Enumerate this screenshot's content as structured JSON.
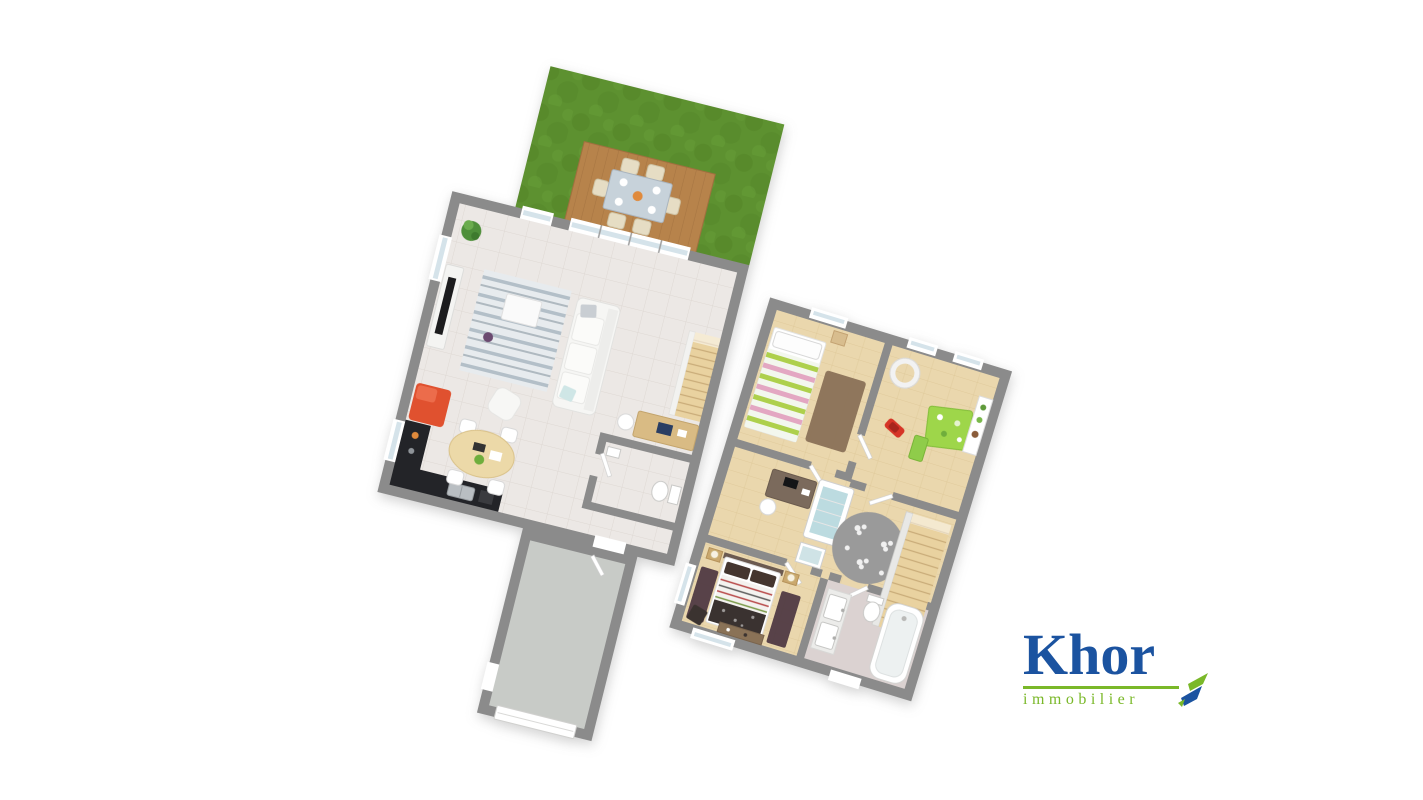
{
  "page": {
    "background": "#ffffff",
    "description": "3d floor plan rendering, two levels with garden"
  },
  "logo": {
    "brand": "Khor",
    "tagline": "immobilier",
    "brand_color": "#1b53a0",
    "accent_color": "#7ab829"
  },
  "palette": {
    "background": "#ffffff",
    "wall": "#8b8b8b",
    "floor_tile": "#ece8e5",
    "tile_line": "#ded8d3",
    "floor_wood": "#ead7ad",
    "wood_line": "#dcc492",
    "bath_floor": "#dbd2d1",
    "garage_floor": "#c8cbc7",
    "grass": "#5d9130",
    "grass_dark": "#538527",
    "grass_light": "#68a139",
    "deck": "#b7834b",
    "deck_line": "#a06f3e",
    "stairs_wood": "#e9d2a0",
    "stair_tread": "#c9ac79",
    "counter": "#232428",
    "fridge": "#e0512f",
    "table_wood": "#ecd9a8",
    "sofa": "#f6f6f4",
    "rug_stripe": "#b3bfc8",
    "play_green": "#9ed64a",
    "toy_red": "#d63426",
    "bed_stripe_green": "#aed04c",
    "bed_stripe_pink": "#e3a7c2",
    "crib_blue": "#bcdbe0",
    "flower_rug": "#9a9a9a",
    "dark_rug": "#4b3540",
    "brown_rug": "#8a7157",
    "dark_throw": "#3a3230",
    "dresser_wood": "#8a7257",
    "window_glass": "#d5e3ea",
    "logo_blue": "#1b53a0",
    "logo_green": "#7ab829"
  },
  "plans": {
    "ground_floor": {
      "name": "ground-floor",
      "rotation_deg": 14,
      "rooms": [
        "garden",
        "terrace",
        "living-room",
        "kitchen",
        "wc",
        "hallway",
        "garage"
      ],
      "furniture": [
        "outdoor-dining-set",
        "potted-plant",
        "tv-console",
        "striped-rug",
        "coffee-table",
        "sofa",
        "pouf",
        "staircase",
        "desk",
        "toilet",
        "fridge",
        "kitchen-counter",
        "sink",
        "round-dining-table"
      ]
    },
    "upper_floor": {
      "name": "upper-floor",
      "rotation_deg": 17,
      "rooms": [
        "bedroom-1",
        "kids-room",
        "landing",
        "stairwell",
        "master-bedroom",
        "bathroom"
      ],
      "furniture": [
        "single-bed",
        "bedside-rug",
        "desk",
        "crib",
        "changing-table",
        "flower-rug",
        "ceiling-lamp",
        "play-table",
        "toy-car",
        "wall-shelf",
        "double-bed",
        "nightstands",
        "dresser",
        "ottoman",
        "bathtub",
        "double-sink-vanity",
        "toilet"
      ]
    }
  }
}
